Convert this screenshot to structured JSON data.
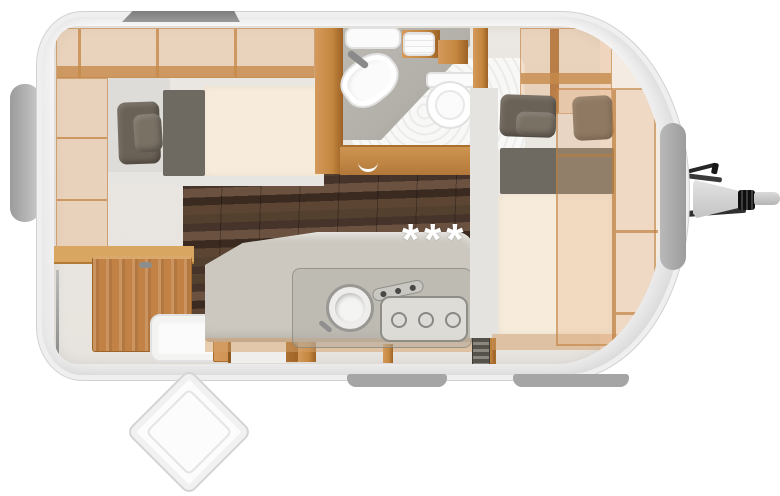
{
  "floorplan": {
    "stars_label": "***",
    "colors": {
      "wood": "#c5873f",
      "wood_dark": "#9c6226",
      "wood_light": "#d49a5c",
      "parquet": "#46332a",
      "upholstery": "#ccc8c0",
      "mattress": "#f7ecdc",
      "pillow": "#6b6257",
      "headboard": "#6e6a62",
      "counter": "#b3b0aa",
      "window_grey": "#a6a6a6",
      "rail_grey": "#8a8a8a",
      "hitch_dark": "#2e2e2e",
      "shell_white": "#f7f7f7",
      "cream_wall": "#f4ebe3",
      "feet_grey": "#a5a5a5"
    }
  }
}
